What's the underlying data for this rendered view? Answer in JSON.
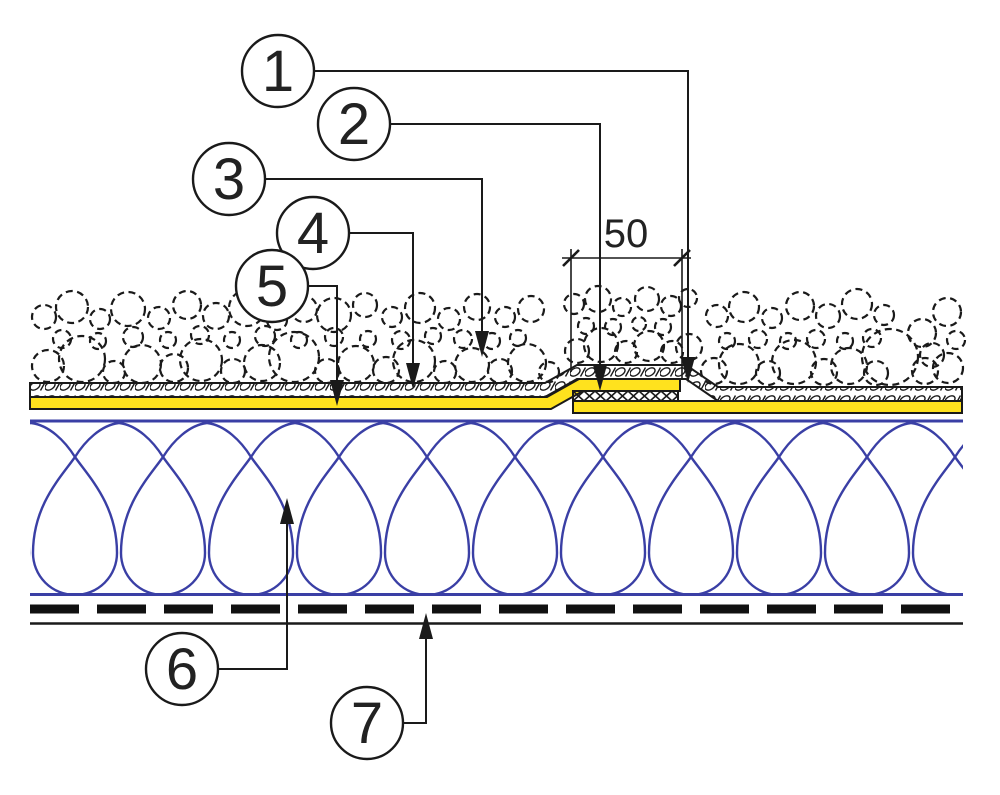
{
  "drawing": {
    "callouts": [
      {
        "label": "1"
      },
      {
        "label": "2"
      },
      {
        "label": "3"
      },
      {
        "label": "4"
      },
      {
        "label": "5"
      },
      {
        "label": "6"
      },
      {
        "label": "7"
      }
    ],
    "dimension": {
      "value": "50"
    },
    "colors": {
      "membrane_yellow": "#ffe21e",
      "insulation_blue": "#3a3fa5",
      "line_black": "#1a1a1a"
    }
  }
}
